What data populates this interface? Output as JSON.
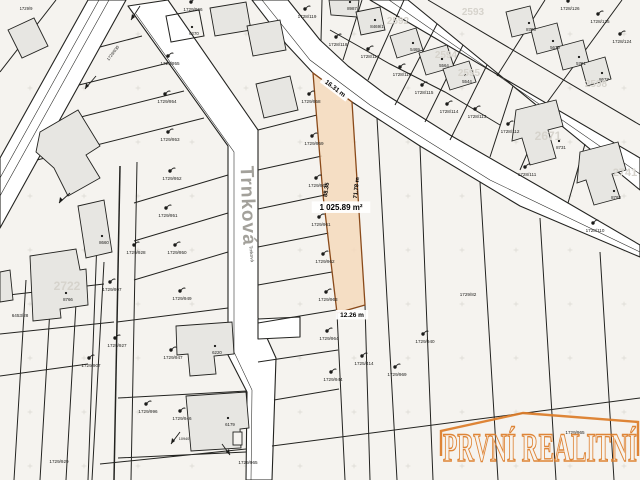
{
  "map": {
    "background": "#f5f3ef",
    "road_fill": "#ffffff",
    "line_color": "#232320",
    "cross_color": "#c9c6bf",
    "building_fill": "#e7e6e2",
    "highlight": {
      "fill": "#f4d9bc",
      "stroke": "#8a4a1a"
    },
    "street_name": "Trnková",
    "watermark": {
      "text": "PRVNÍ REALITNÍ",
      "color": "#dd7c28"
    },
    "dimensions": {
      "top": "16.31 m",
      "area": "1 025.89 m²",
      "bottom": "12.26 m",
      "left": "88.35",
      "right": "71.78 m"
    },
    "labels": [
      {
        "t": "1729/9",
        "x": 26,
        "y": 10,
        "s": 4.2,
        "c": "p"
      },
      {
        "t": "1729/966",
        "x": 193,
        "y": 11,
        "c": "p",
        "m": 1
      },
      {
        "t": "1729/955",
        "x": 170,
        "y": 65,
        "c": "p",
        "m": 1
      },
      {
        "t": "1729/954",
        "x": 167,
        "y": 103,
        "c": "p",
        "m": 1
      },
      {
        "t": "1729/953",
        "x": 170,
        "y": 141,
        "c": "p",
        "m": 1
      },
      {
        "t": "1729/952",
        "x": 172,
        "y": 180,
        "c": "p",
        "m": 1
      },
      {
        "t": "1729/951",
        "x": 168,
        "y": 217,
        "c": "p",
        "m": 1
      },
      {
        "t": "1729/950",
        "x": 177,
        "y": 254,
        "c": "p",
        "m": 1
      },
      {
        "t": "1729/949",
        "x": 182,
        "y": 300,
        "c": "p",
        "m": 1
      },
      {
        "t": "1729/947",
        "x": 173,
        "y": 359,
        "c": "p",
        "m": 1
      },
      {
        "t": "1729/946",
        "x": 182,
        "y": 420,
        "c": "p",
        "m": 1
      },
      {
        "t": "1729/928",
        "x": 136,
        "y": 254,
        "c": "p",
        "m": 1
      },
      {
        "t": "1729/997",
        "x": 112,
        "y": 291,
        "c": "p",
        "m": 1
      },
      {
        "t": "1729/927",
        "x": 117,
        "y": 347,
        "c": "p",
        "m": 1
      },
      {
        "t": "1729/907",
        "x": 91,
        "y": 367,
        "c": "p",
        "m": 1
      },
      {
        "t": "1729/996",
        "x": 148,
        "y": 413,
        "c": "p",
        "m": 1
      },
      {
        "t": "1729/929",
        "x": 59,
        "y": 463,
        "c": "p"
      },
      {
        "t": "6453/28",
        "x": 20,
        "y": 317,
        "c": "p"
      },
      {
        "t": "1729/930",
        "x": 114,
        "y": 54,
        "r": -53,
        "s": 4.2,
        "c": "p"
      },
      {
        "t": "1729/958",
        "x": 311,
        "y": 103,
        "c": "p",
        "m": 1
      },
      {
        "t": "1729/959",
        "x": 314,
        "y": 145,
        "c": "p",
        "m": 1
      },
      {
        "t": "1729/960",
        "x": 318,
        "y": 187,
        "c": "p",
        "m": 1
      },
      {
        "t": "1729/961",
        "x": 321,
        "y": 226,
        "c": "p",
        "m": 1
      },
      {
        "t": "1729/962",
        "x": 325,
        "y": 263,
        "c": "p",
        "m": 1
      },
      {
        "t": "1729/963",
        "x": 328,
        "y": 301,
        "c": "p",
        "m": 1
      },
      {
        "t": "1729/964",
        "x": 329,
        "y": 340,
        "c": "p",
        "m": 1
      },
      {
        "t": "1729/944",
        "x": 333,
        "y": 381,
        "c": "p",
        "m": 1
      },
      {
        "t": "1725/414",
        "x": 364,
        "y": 365,
        "c": "p",
        "m": 1
      },
      {
        "t": "1729/969",
        "x": 397,
        "y": 376,
        "c": "p",
        "m": 1
      },
      {
        "t": "1729/940",
        "x": 425,
        "y": 343,
        "c": "p",
        "m": 1
      },
      {
        "t": "1729/82",
        "x": 468,
        "y": 296,
        "c": "p"
      },
      {
        "t": "1729/965",
        "x": 248,
        "y": 464,
        "c": "p"
      },
      {
        "t": "1729/965",
        "x": 575,
        "y": 434,
        "c": "p"
      },
      {
        "t": "10940",
        "x": 184,
        "y": 440,
        "s": 3.8,
        "c": "p"
      },
      {
        "t": "1728/119",
        "x": 307,
        "y": 18,
        "c": "p",
        "m": 1
      },
      {
        "t": "1728/118",
        "x": 338,
        "y": 46,
        "c": "p",
        "m": 1
      },
      {
        "t": "1728/117",
        "x": 370,
        "y": 58,
        "c": "p",
        "m": 1
      },
      {
        "t": "1728/116",
        "x": 402,
        "y": 76,
        "c": "p",
        "m": 1
      },
      {
        "t": "1728/115",
        "x": 424,
        "y": 94,
        "c": "p",
        "m": 1
      },
      {
        "t": "1728/114",
        "x": 449,
        "y": 113,
        "c": "p",
        "m": 1
      },
      {
        "t": "1728/113",
        "x": 477,
        "y": 118,
        "c": "p",
        "m": 1
      },
      {
        "t": "1728/112",
        "x": 510,
        "y": 133,
        "c": "p",
        "m": 1
      },
      {
        "t": "1728/126",
        "x": 570,
        "y": 10,
        "c": "p",
        "m": 1
      },
      {
        "t": "1728/125",
        "x": 600,
        "y": 23,
        "c": "p",
        "m": 1
      },
      {
        "t": "1728/124",
        "x": 622,
        "y": 43,
        "c": "p",
        "m": 1
      },
      {
        "t": "1728/111",
        "x": 527,
        "y": 176,
        "c": "p",
        "m": 1
      },
      {
        "t": "1728/110",
        "x": 595,
        "y": 232,
        "c": "p",
        "m": 1
      },
      {
        "t": "8987",
        "x": 352,
        "y": 10,
        "s": 4.4,
        "c": "b",
        "dot": 1
      },
      {
        "t": "8469/1",
        "x": 377,
        "y": 28,
        "s": 4.4,
        "c": "b",
        "dot": 1
      },
      {
        "t": "5469",
        "x": 415,
        "y": 51,
        "s": 4.4,
        "c": "b",
        "dot": 1
      },
      {
        "t": "5564",
        "x": 444,
        "y": 67,
        "s": 4.4,
        "c": "b",
        "dot": 1
      },
      {
        "t": "5544",
        "x": 467,
        "y": 83,
        "s": 4.4,
        "c": "b",
        "dot": 1
      },
      {
        "t": "8706",
        "x": 531,
        "y": 31,
        "s": 4.4,
        "c": "b",
        "dot": 1
      },
      {
        "t": "5679",
        "x": 555,
        "y": 49,
        "s": 4.4,
        "c": "b",
        "dot": 1
      },
      {
        "t": "5791",
        "x": 581,
        "y": 65,
        "s": 4.4,
        "c": "b",
        "dot": 1
      },
      {
        "t": "8677",
        "x": 604,
        "y": 81,
        "s": 4.4,
        "c": "b",
        "dot": 1
      },
      {
        "t": "8731",
        "x": 561,
        "y": 149,
        "s": 4.4,
        "c": "b",
        "dot": 1
      },
      {
        "t": "8793",
        "x": 616,
        "y": 199,
        "s": 4.4,
        "c": "b",
        "dot": 1
      },
      {
        "t": "6270",
        "x": 194,
        "y": 35,
        "s": 4.4,
        "c": "b",
        "dot": 1
      },
      {
        "t": "8660",
        "x": 104,
        "y": 244,
        "s": 4.4,
        "c": "b",
        "dot": 1
      },
      {
        "t": "8766",
        "x": 68,
        "y": 301,
        "s": 4.4,
        "c": "b",
        "dot": 1
      },
      {
        "t": "6220",
        "x": 217,
        "y": 354,
        "s": 4.4,
        "c": "b",
        "dot": 1
      },
      {
        "t": "6179",
        "x": 230,
        "y": 426,
        "s": 4.4,
        "c": "b",
        "dot": 1
      },
      {
        "t": "2592",
        "x": 398,
        "y": 24,
        "s": 10,
        "c": "g"
      },
      {
        "t": "2593",
        "x": 473,
        "y": 15,
        "s": 10,
        "c": "g"
      },
      {
        "t": "2594",
        "x": 446,
        "y": 58,
        "s": 10,
        "c": "g"
      },
      {
        "t": "2595",
        "x": 469,
        "y": 76,
        "s": 10,
        "c": "g"
      },
      {
        "t": "2598",
        "x": 596,
        "y": 87,
        "s": 10,
        "c": "g"
      },
      {
        "t": "2671",
        "x": 548,
        "y": 140,
        "s": 12,
        "c": "g"
      },
      {
        "t": "2741",
        "x": 625,
        "y": 176,
        "s": 11,
        "c": "g"
      },
      {
        "t": "2722",
        "x": 67,
        "y": 290,
        "s": 12,
        "c": "g"
      },
      {
        "t": "Trnková",
        "x": 242,
        "y": 206,
        "r": 88,
        "s": 19,
        "c": "s"
      },
      {
        "t": "Trnková",
        "x": 250,
        "y": 254,
        "r": 84,
        "s": 4.6,
        "c": "s2"
      },
      {
        "t": "16.31 m",
        "x": 334,
        "y": 90,
        "r": 37,
        "s": 6.5,
        "c": "d",
        "chip": 1
      },
      {
        "t": "88.35",
        "x": 328,
        "y": 190,
        "r": -82,
        "s": 5.8,
        "c": "d"
      },
      {
        "t": "71.78 m",
        "x": 358,
        "y": 188,
        "r": -84,
        "s": 5.8,
        "c": "d"
      },
      {
        "t": "1 025.89 m²",
        "x": 341,
        "y": 210,
        "s": 8,
        "c": "d",
        "chip": 1
      },
      {
        "t": "12.26 m",
        "x": 352,
        "y": 317,
        "s": 6.5,
        "c": "d",
        "chip": 1
      }
    ]
  }
}
